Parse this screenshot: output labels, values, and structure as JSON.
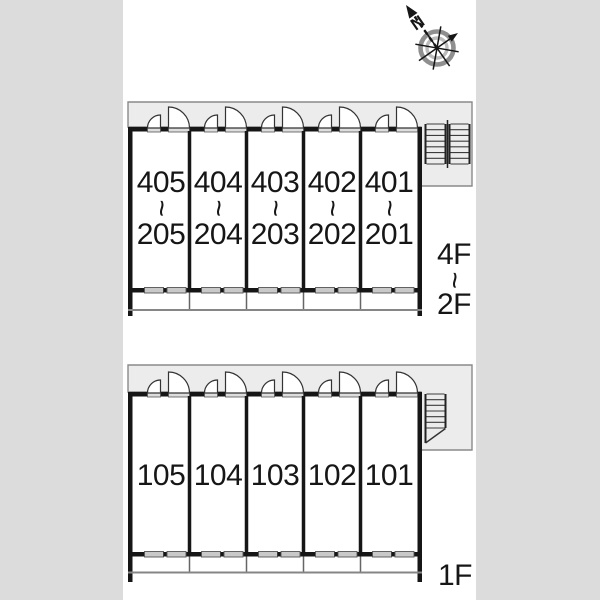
{
  "page": {
    "background": "#ffffff",
    "side_band_color": "#dcdcdc"
  },
  "compass": {
    "north": "N"
  },
  "upper_building": {
    "floor_top": "4F",
    "floor_separator": "~",
    "floor_bottom": "2F",
    "rooms": [
      {
        "top": "405",
        "separator": "~",
        "bottom": "205"
      },
      {
        "top": "404",
        "separator": "~",
        "bottom": "204"
      },
      {
        "top": "403",
        "separator": "~",
        "bottom": "203"
      },
      {
        "top": "402",
        "separator": "~",
        "bottom": "202"
      },
      {
        "top": "401",
        "separator": "~",
        "bottom": "201"
      }
    ]
  },
  "lower_building": {
    "floor_label": "1F",
    "rooms": [
      {
        "label": "105"
      },
      {
        "label": "104"
      },
      {
        "label": "103"
      },
      {
        "label": "102"
      },
      {
        "label": "101"
      }
    ]
  }
}
